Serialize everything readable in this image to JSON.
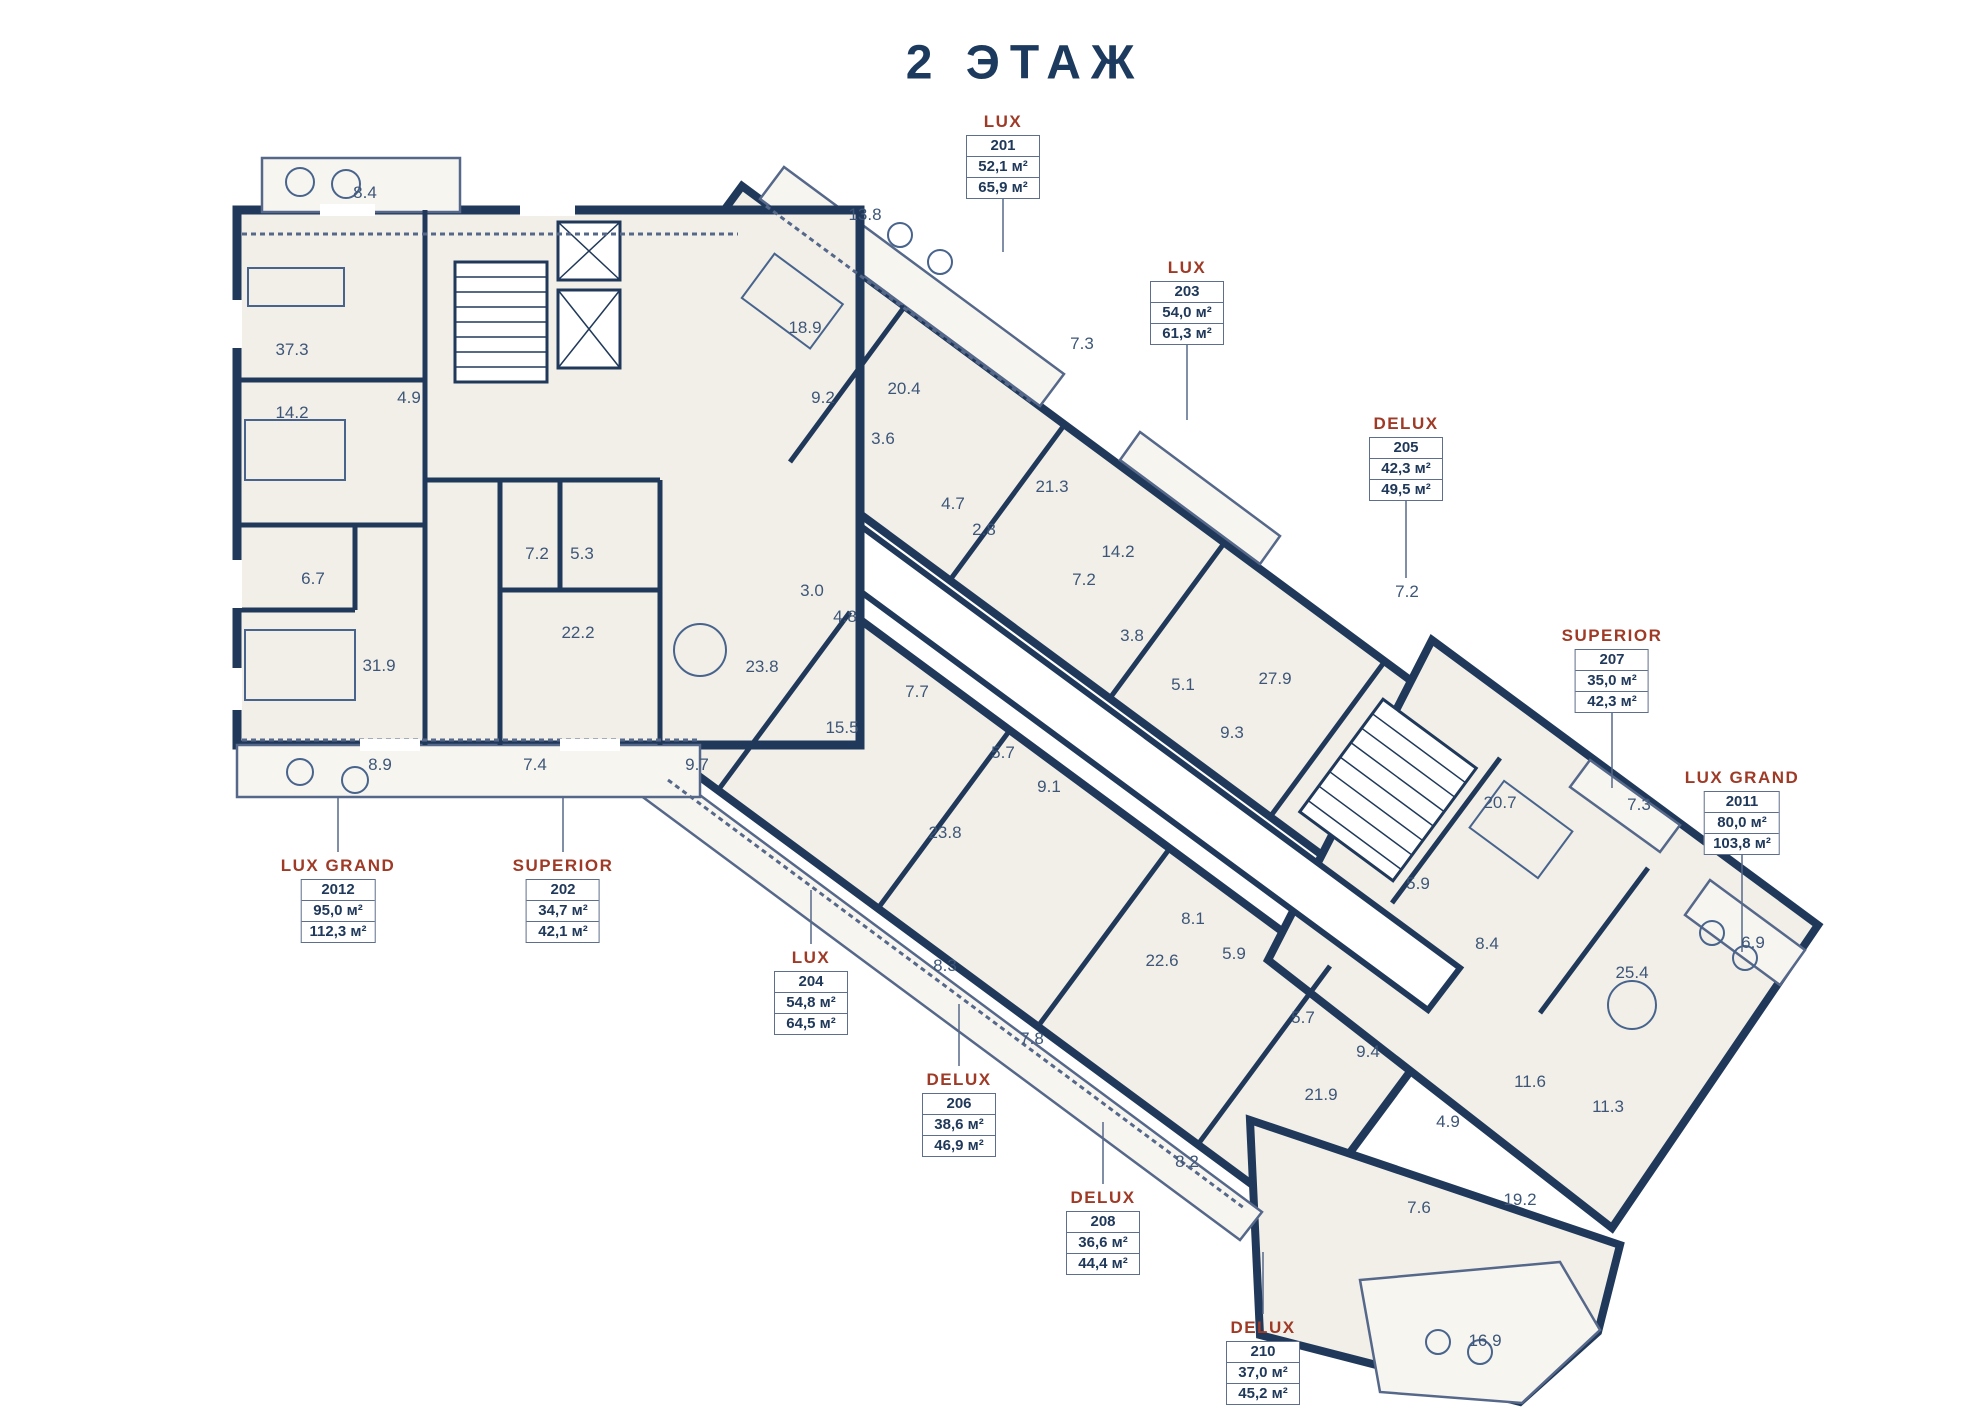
{
  "title": "2 ЭТАЖ",
  "colors": {
    "wall": "#20395a",
    "room_fill": "#f2efe9",
    "balcony_fill": "#f7f5f0",
    "accent_label": "#9e3a26",
    "room_text": "#3d5678",
    "background": "#ffffff"
  },
  "apartments": [
    {
      "type": "LUX",
      "unit": "201",
      "area_main": "52,1 м²",
      "area_total": "65,9 м²",
      "x": 1003,
      "y": 112,
      "leader": [
        1003,
        196,
        1003,
        252
      ]
    },
    {
      "type": "LUX",
      "unit": "203",
      "area_main": "54,0 м²",
      "area_total": "61,3 м²",
      "x": 1187,
      "y": 258,
      "leader": [
        1187,
        334,
        1187,
        420
      ]
    },
    {
      "type": "DELUX",
      "unit": "205",
      "area_main": "42,3 м²",
      "area_total": "49,5 м²",
      "x": 1406,
      "y": 414,
      "leader": [
        1406,
        490,
        1406,
        578
      ]
    },
    {
      "type": "SUPERIOR",
      "unit": "207",
      "area_main": "35,0 м²",
      "area_total": "42,3 м²",
      "x": 1612,
      "y": 626,
      "leader": [
        1612,
        703,
        1612,
        788
      ]
    },
    {
      "type": "LUX GRAND",
      "unit": "2011",
      "area_main": "80,0 м²",
      "area_total": "103,8 м²",
      "x": 1742,
      "y": 768,
      "leader": [
        1742,
        846,
        1742,
        952
      ]
    },
    {
      "type": "LUX GRAND",
      "unit": "2012",
      "area_main": "95,0 м²",
      "area_total": "112,3 м²",
      "x": 338,
      "y": 856,
      "leader": [
        338,
        852,
        338,
        798
      ]
    },
    {
      "type": "SUPERIOR",
      "unit": "202",
      "area_main": "34,7 м²",
      "area_total": "42,1 м²",
      "x": 563,
      "y": 856,
      "leader": [
        563,
        852,
        563,
        798
      ]
    },
    {
      "type": "LUX",
      "unit": "204",
      "area_main": "54,8 м²",
      "area_total": "64,5 м²",
      "x": 811,
      "y": 948,
      "leader": [
        811,
        944,
        811,
        890
      ]
    },
    {
      "type": "DELUX",
      "unit": "206",
      "area_main": "38,6 м²",
      "area_total": "46,9 м²",
      "x": 959,
      "y": 1070,
      "leader": [
        959,
        1066,
        959,
        1004
      ]
    },
    {
      "type": "DELUX",
      "unit": "208",
      "area_main": "36,6 м²",
      "area_total": "44,4 м²",
      "x": 1103,
      "y": 1188,
      "leader": [
        1103,
        1184,
        1103,
        1122
      ]
    },
    {
      "type": "DELUX",
      "unit": "210",
      "area_main": "37,0 м²",
      "area_total": "45,2 м²",
      "x": 1263,
      "y": 1318,
      "leader": [
        1263,
        1314,
        1263,
        1252
      ]
    }
  ],
  "rooms": [
    {
      "v": "8.4",
      "x": 365,
      "y": 193
    },
    {
      "v": "37.3",
      "x": 292,
      "y": 350
    },
    {
      "v": "14.2",
      "x": 292,
      "y": 413
    },
    {
      "v": "4.9",
      "x": 409,
      "y": 398
    },
    {
      "v": "6.7",
      "x": 313,
      "y": 579
    },
    {
      "v": "31.9",
      "x": 379,
      "y": 666
    },
    {
      "v": "7.2",
      "x": 537,
      "y": 554
    },
    {
      "v": "5.3",
      "x": 582,
      "y": 554
    },
    {
      "v": "22.2",
      "x": 578,
      "y": 633
    },
    {
      "v": "8.9",
      "x": 380,
      "y": 765
    },
    {
      "v": "7.4",
      "x": 535,
      "y": 765
    },
    {
      "v": "9.7",
      "x": 697,
      "y": 765
    },
    {
      "v": "13.8",
      "x": 865,
      "y": 215
    },
    {
      "v": "18.9",
      "x": 805,
      "y": 328
    },
    {
      "v": "9.2",
      "x": 823,
      "y": 398
    },
    {
      "v": "20.4",
      "x": 904,
      "y": 389
    },
    {
      "v": "3.6",
      "x": 883,
      "y": 439
    },
    {
      "v": "7.3",
      "x": 1082,
      "y": 344
    },
    {
      "v": "21.3",
      "x": 1052,
      "y": 487
    },
    {
      "v": "4.7",
      "x": 953,
      "y": 504
    },
    {
      "v": "2.8",
      "x": 984,
      "y": 530
    },
    {
      "v": "14.2",
      "x": 1118,
      "y": 552
    },
    {
      "v": "7.2",
      "x": 1084,
      "y": 580
    },
    {
      "v": "3.0",
      "x": 812,
      "y": 591
    },
    {
      "v": "4.8",
      "x": 845,
      "y": 617
    },
    {
      "v": "23.8",
      "x": 762,
      "y": 667
    },
    {
      "v": "7.7",
      "x": 917,
      "y": 692
    },
    {
      "v": "15.5",
      "x": 842,
      "y": 728
    },
    {
      "v": "5.7",
      "x": 1003,
      "y": 753
    },
    {
      "v": "9.1",
      "x": 1049,
      "y": 787
    },
    {
      "v": "23.8",
      "x": 945,
      "y": 833
    },
    {
      "v": "3.8",
      "x": 1132,
      "y": 636
    },
    {
      "v": "5.1",
      "x": 1183,
      "y": 685
    },
    {
      "v": "9.3",
      "x": 1232,
      "y": 733
    },
    {
      "v": "27.9",
      "x": 1275,
      "y": 679
    },
    {
      "v": "7.2",
      "x": 1407,
      "y": 592
    },
    {
      "v": "8.1",
      "x": 1193,
      "y": 919
    },
    {
      "v": "5.9",
      "x": 1234,
      "y": 954
    },
    {
      "v": "22.6",
      "x": 1162,
      "y": 961
    },
    {
      "v": "8.3",
      "x": 945,
      "y": 966
    },
    {
      "v": "7.8",
      "x": 1032,
      "y": 1039
    },
    {
      "v": "5.7",
      "x": 1303,
      "y": 1018
    },
    {
      "v": "9.4",
      "x": 1368,
      "y": 1052
    },
    {
      "v": "21.9",
      "x": 1321,
      "y": 1095
    },
    {
      "v": "8.2",
      "x": 1187,
      "y": 1162
    },
    {
      "v": "4.9",
      "x": 1448,
      "y": 1122
    },
    {
      "v": "7.6",
      "x": 1419,
      "y": 1208
    },
    {
      "v": "19.2",
      "x": 1520,
      "y": 1200
    },
    {
      "v": "16.9",
      "x": 1485,
      "y": 1341
    },
    {
      "v": "11.6",
      "x": 1530,
      "y": 1082
    },
    {
      "v": "11.3",
      "x": 1608,
      "y": 1107
    },
    {
      "v": "25.4",
      "x": 1632,
      "y": 973
    },
    {
      "v": "6.9",
      "x": 1753,
      "y": 943
    },
    {
      "v": "8.4",
      "x": 1487,
      "y": 944
    },
    {
      "v": "5.9",
      "x": 1418,
      "y": 884
    },
    {
      "v": "20.7",
      "x": 1500,
      "y": 803
    },
    {
      "v": "7.3",
      "x": 1639,
      "y": 805
    }
  ]
}
